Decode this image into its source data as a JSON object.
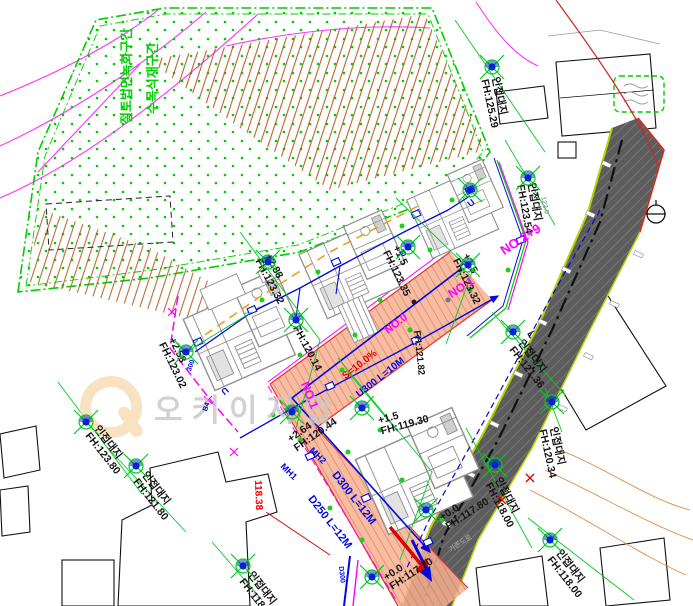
{
  "palette": {
    "green": "#00cc00",
    "magenta": "#ff00ff",
    "blue": "#0008e0",
    "red": "#e02000",
    "salmon": "#f4b193",
    "road_gray": "#5c5c5c",
    "hachure_brown": "#b45a20",
    "watermark_gray": "#c6c6c6",
    "watermark_orange": "#f8dcb4"
  },
  "watermark": {
    "text": "오키이저압"
  },
  "labels": [
    {
      "n": "adjacent-lot-elevation",
      "t": "인접대지\nFH:125.29",
      "x": 500,
      "y": 76,
      "rot": 78,
      "c": "k"
    },
    {
      "n": "adjacent-lot-elevation",
      "t": "인접대지\nFH:123.54",
      "x": 536,
      "y": 182,
      "rot": 80,
      "c": "k"
    },
    {
      "n": "site-level",
      "t": "+1.5\nFH:123.35",
      "x": 400,
      "y": 244,
      "rot": 64,
      "c": "k"
    },
    {
      "n": "site-level",
      "t": "+1.5\nFH:123.32",
      "x": 470,
      "y": 252,
      "rot": 64,
      "c": "k"
    },
    {
      "n": "site-level",
      "t": "+2.88\nFH:123.32",
      "x": 272,
      "y": 252,
      "rot": 62,
      "c": "k"
    },
    {
      "n": "site-level",
      "t": "FH:120.14",
      "x": 300,
      "y": 324,
      "rot": 62,
      "c": "k"
    },
    {
      "n": "site-level",
      "t": "+2.58\nFH:123.02",
      "x": 176,
      "y": 336,
      "rot": 64,
      "c": "k"
    },
    {
      "n": "site-level",
      "t": "+2.64\nFH:120.44",
      "x": 286,
      "y": 436,
      "rot": -35,
      "c": "k"
    },
    {
      "n": "site-level",
      "t": "+1.5\nFH:119.30",
      "x": 377,
      "y": 416,
      "rot": -15,
      "c": "k"
    },
    {
      "n": "site-level",
      "t": "+0.0\nFH:117.80",
      "x": 438,
      "y": 514,
      "rot": -33,
      "c": "k"
    },
    {
      "n": "site-level",
      "t": "+0.0\nFH:117.70",
      "x": 382,
      "y": 574,
      "rot": -33,
      "c": "k"
    },
    {
      "n": "adjacent-lot-elevation",
      "t": "인접대지\nFH:121.36",
      "x": 524,
      "y": 338,
      "rot": 52,
      "c": "k"
    },
    {
      "n": "adjacent-lot-elevation",
      "t": "인접대지\nFH:120.34",
      "x": 558,
      "y": 426,
      "rot": 78,
      "c": "k"
    },
    {
      "n": "adjacent-lot-elevation",
      "t": "인접대지\nFH:118.00",
      "x": 502,
      "y": 476,
      "rot": 62,
      "c": "k"
    },
    {
      "n": "adjacent-lot-elevation",
      "t": "인접대지\nFH:118.00",
      "x": 562,
      "y": 548,
      "rot": 52,
      "c": "k"
    },
    {
      "n": "adjacent-lot-elevation",
      "t": "인접대지\nFH:123.80",
      "x": 100,
      "y": 424,
      "rot": 52,
      "c": "k"
    },
    {
      "n": "adjacent-lot-elevation",
      "t": "인접대지\nFH:121.80",
      "x": 148,
      "y": 470,
      "rot": 52,
      "c": "k"
    },
    {
      "n": "adjacent-lot-elevation",
      "t": "인접대지\nFH:118.78",
      "x": 254,
      "y": 570,
      "rot": 52,
      "c": "k"
    },
    {
      "n": "site-level",
      "t": "FH:121.82",
      "x": 421,
      "y": 330,
      "rot": 84,
      "c": "k",
      "s": 9.5
    },
    {
      "n": "ground-elevation",
      "t": "118.38",
      "x": 262,
      "y": 480,
      "rot": 88,
      "c": "r",
      "s": 10
    },
    {
      "n": "station-label",
      "t": "NO.2+9",
      "x": 498,
      "y": 246,
      "rot": -33,
      "c": "m",
      "s": 13,
      "w": 700
    },
    {
      "n": "station-label",
      "t": "NO.1",
      "x": 446,
      "y": 290,
      "rot": -33,
      "c": "m",
      "s": 12,
      "w": 700
    },
    {
      "n": "station-label",
      "t": "NO.1",
      "x": 310,
      "y": 380,
      "rot": 68,
      "c": "m",
      "s": 12,
      "w": 700
    },
    {
      "n": "pipe-label",
      "t": "D300 L=12M",
      "x": 338,
      "y": 470,
      "rot": 52,
      "c": "b",
      "s": 11,
      "w": 700
    },
    {
      "n": "pipe-label",
      "t": "D250 L=12M",
      "x": 314,
      "y": 494,
      "rot": 52,
      "c": "b",
      "s": 11,
      "w": 700
    },
    {
      "n": "manhole-label",
      "t": "MH2",
      "x": 314,
      "y": 446,
      "rot": 45,
      "c": "b",
      "s": 9,
      "w": 700
    },
    {
      "n": "manhole-label",
      "t": "MH1",
      "x": 285,
      "y": 462,
      "rot": 45,
      "c": "b",
      "s": 9,
      "w": 700
    },
    {
      "n": "ramp-slope-label",
      "t": "S=10.0%",
      "x": 341,
      "y": 374,
      "rot": -38,
      "c": "r",
      "s": 10,
      "w": 700
    },
    {
      "n": "gutter-label",
      "t": "U300 L=10M",
      "x": 355,
      "y": 392,
      "rot": -38,
      "c": "b",
      "s": 10,
      "w": 700
    },
    {
      "n": "station-label",
      "t": "NO.0",
      "x": 383,
      "y": 328,
      "rot": -38,
      "c": "m",
      "s": 11,
      "w": 700
    },
    {
      "n": "pipe-label",
      "t": "B4",
      "x": 202,
      "y": 410,
      "rot": -70,
      "c": "b",
      "s": 7
    },
    {
      "n": "pipe-label",
      "t": "300",
      "x": 186,
      "y": 370,
      "rot": -70,
      "c": "b",
      "s": 7
    },
    {
      "n": "pipe-label",
      "t": "D300",
      "x": 344,
      "y": 566,
      "rot": 84,
      "c": "b",
      "s": 7
    },
    {
      "n": "road-label",
      "t": "기존도로",
      "x": 448,
      "y": 548,
      "rot": -33,
      "c": "gy",
      "s": 7
    },
    {
      "n": "contour-label",
      "t": "122.0",
      "x": 546,
      "y": 196,
      "rot": 78,
      "c": "gy",
      "s": 7
    },
    {
      "n": "gutter-mark",
      "t": "U",
      "x": 230,
      "y": 392,
      "rot": 140,
      "c": "b",
      "s": 9,
      "w": 700
    },
    {
      "n": "gutter-mark",
      "t": "U",
      "x": 466,
      "y": 202,
      "rot": -40,
      "c": "b",
      "s": 9,
      "w": 700
    },
    {
      "n": "gutter-mark",
      "t": "U",
      "x": 398,
      "y": 252,
      "rot": -40,
      "c": "b",
      "s": 9,
      "w": 700
    },
    {
      "n": "slope-note",
      "t": "절토법면녹화구간",
      "x": 120,
      "y": 124,
      "rot": -90,
      "c": "g",
      "s": 13,
      "w": 700
    },
    {
      "n": "planting-note",
      "t": "수목식재구간",
      "x": 146,
      "y": 114,
      "rot": -90,
      "c": "g",
      "s": 13,
      "w": 700
    }
  ],
  "spots": [
    [
      492,
      67
    ],
    [
      528,
      178
    ],
    [
      408,
      247
    ],
    [
      468,
      265
    ],
    [
      268,
      262
    ],
    [
      296,
      320
    ],
    [
      186,
      352
    ],
    [
      292,
      412
    ],
    [
      362,
      408
    ],
    [
      426,
      510
    ],
    [
      372,
      577
    ],
    [
      513,
      332
    ],
    [
      552,
      402
    ],
    [
      495,
      465
    ],
    [
      550,
      540
    ],
    [
      86,
      422
    ],
    [
      136,
      466
    ],
    [
      243,
      566
    ],
    [
      470,
      190
    ]
  ]
}
